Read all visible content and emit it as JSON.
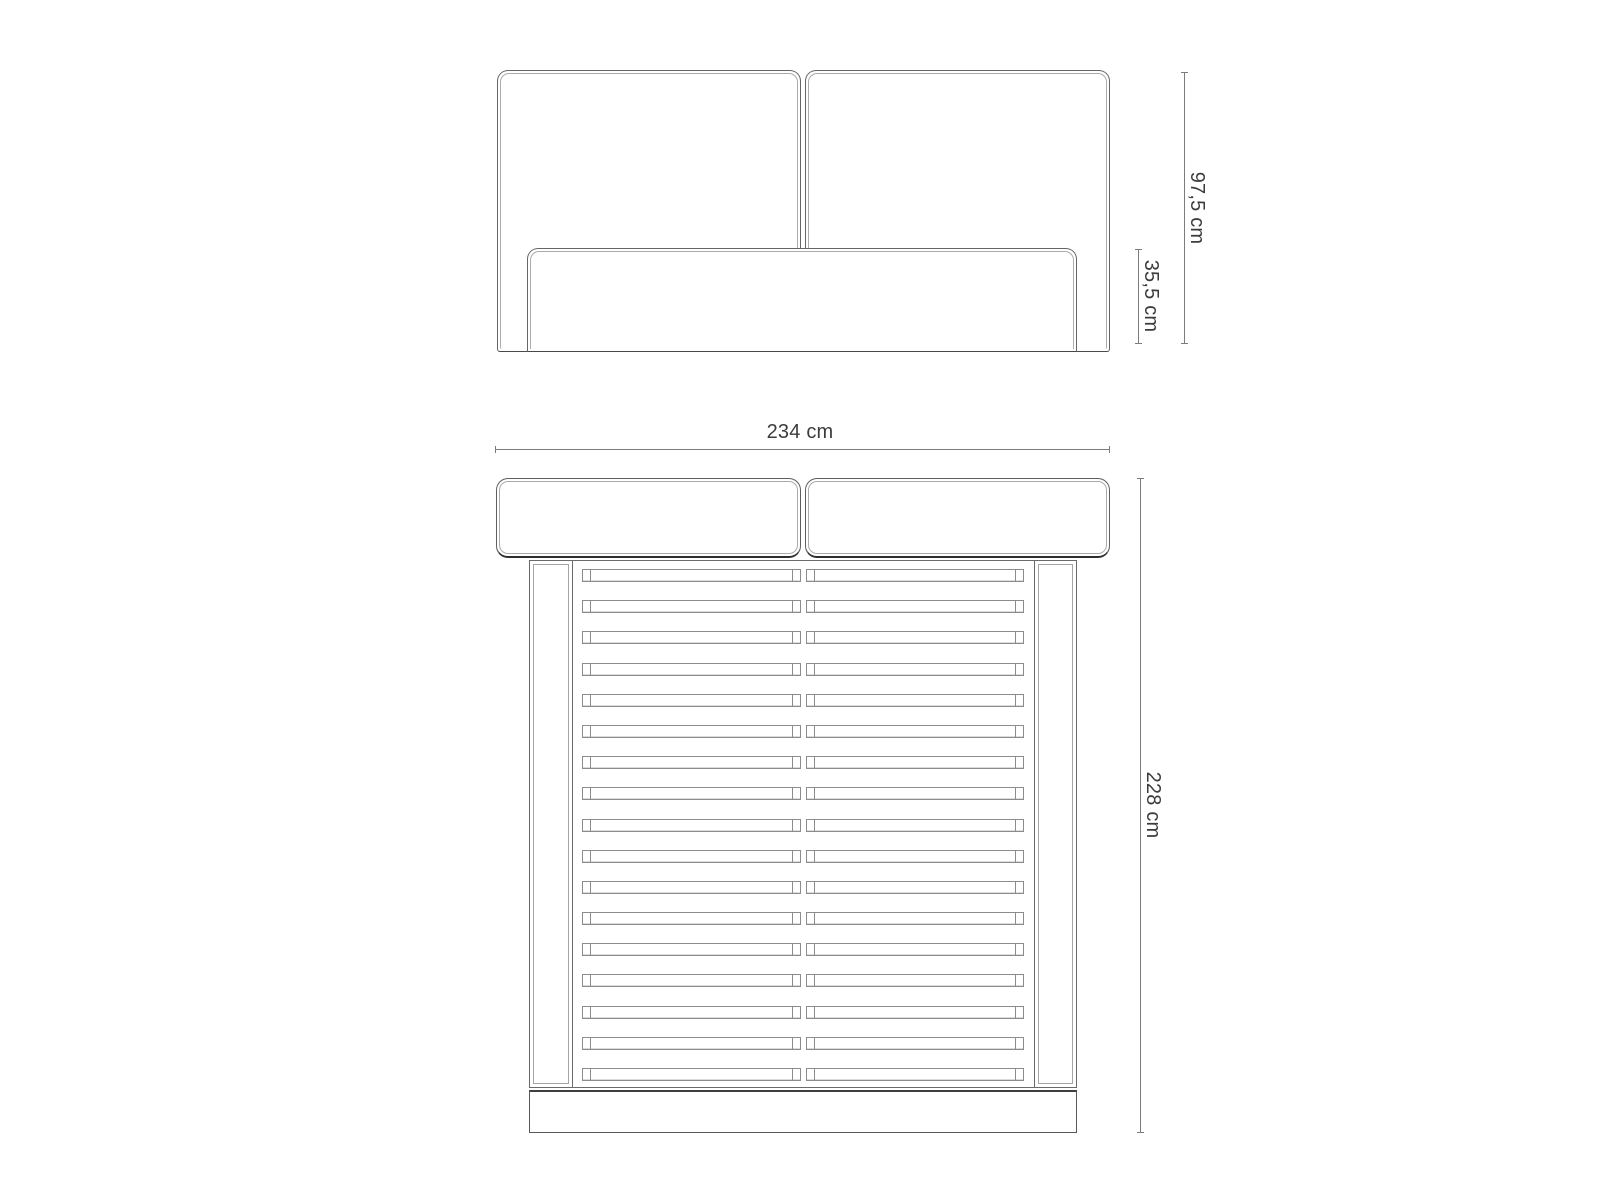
{
  "document": {
    "type": "furniture-technical-drawing",
    "subject": "upholstered bed with slatted frame",
    "background": "#ffffff"
  },
  "colors": {
    "outline": "#666666",
    "inner_outline": "#ababab",
    "slat_outline": "#8c8c8c",
    "emphasis_edge": "#2e2e2e",
    "dimension_line": "#7c7c7c",
    "text": "#3c3c3c"
  },
  "front_view": {
    "name": "front-elevation",
    "headboard_panels": 2,
    "height_label": "97,5 cm",
    "base_height_label": "35,5 cm"
  },
  "top_view": {
    "name": "top-plan-view",
    "headboard_cushions": 2,
    "slat_count": 17,
    "slats_per_row": 2,
    "width_label": "234 cm",
    "length_label": "228 cm"
  }
}
